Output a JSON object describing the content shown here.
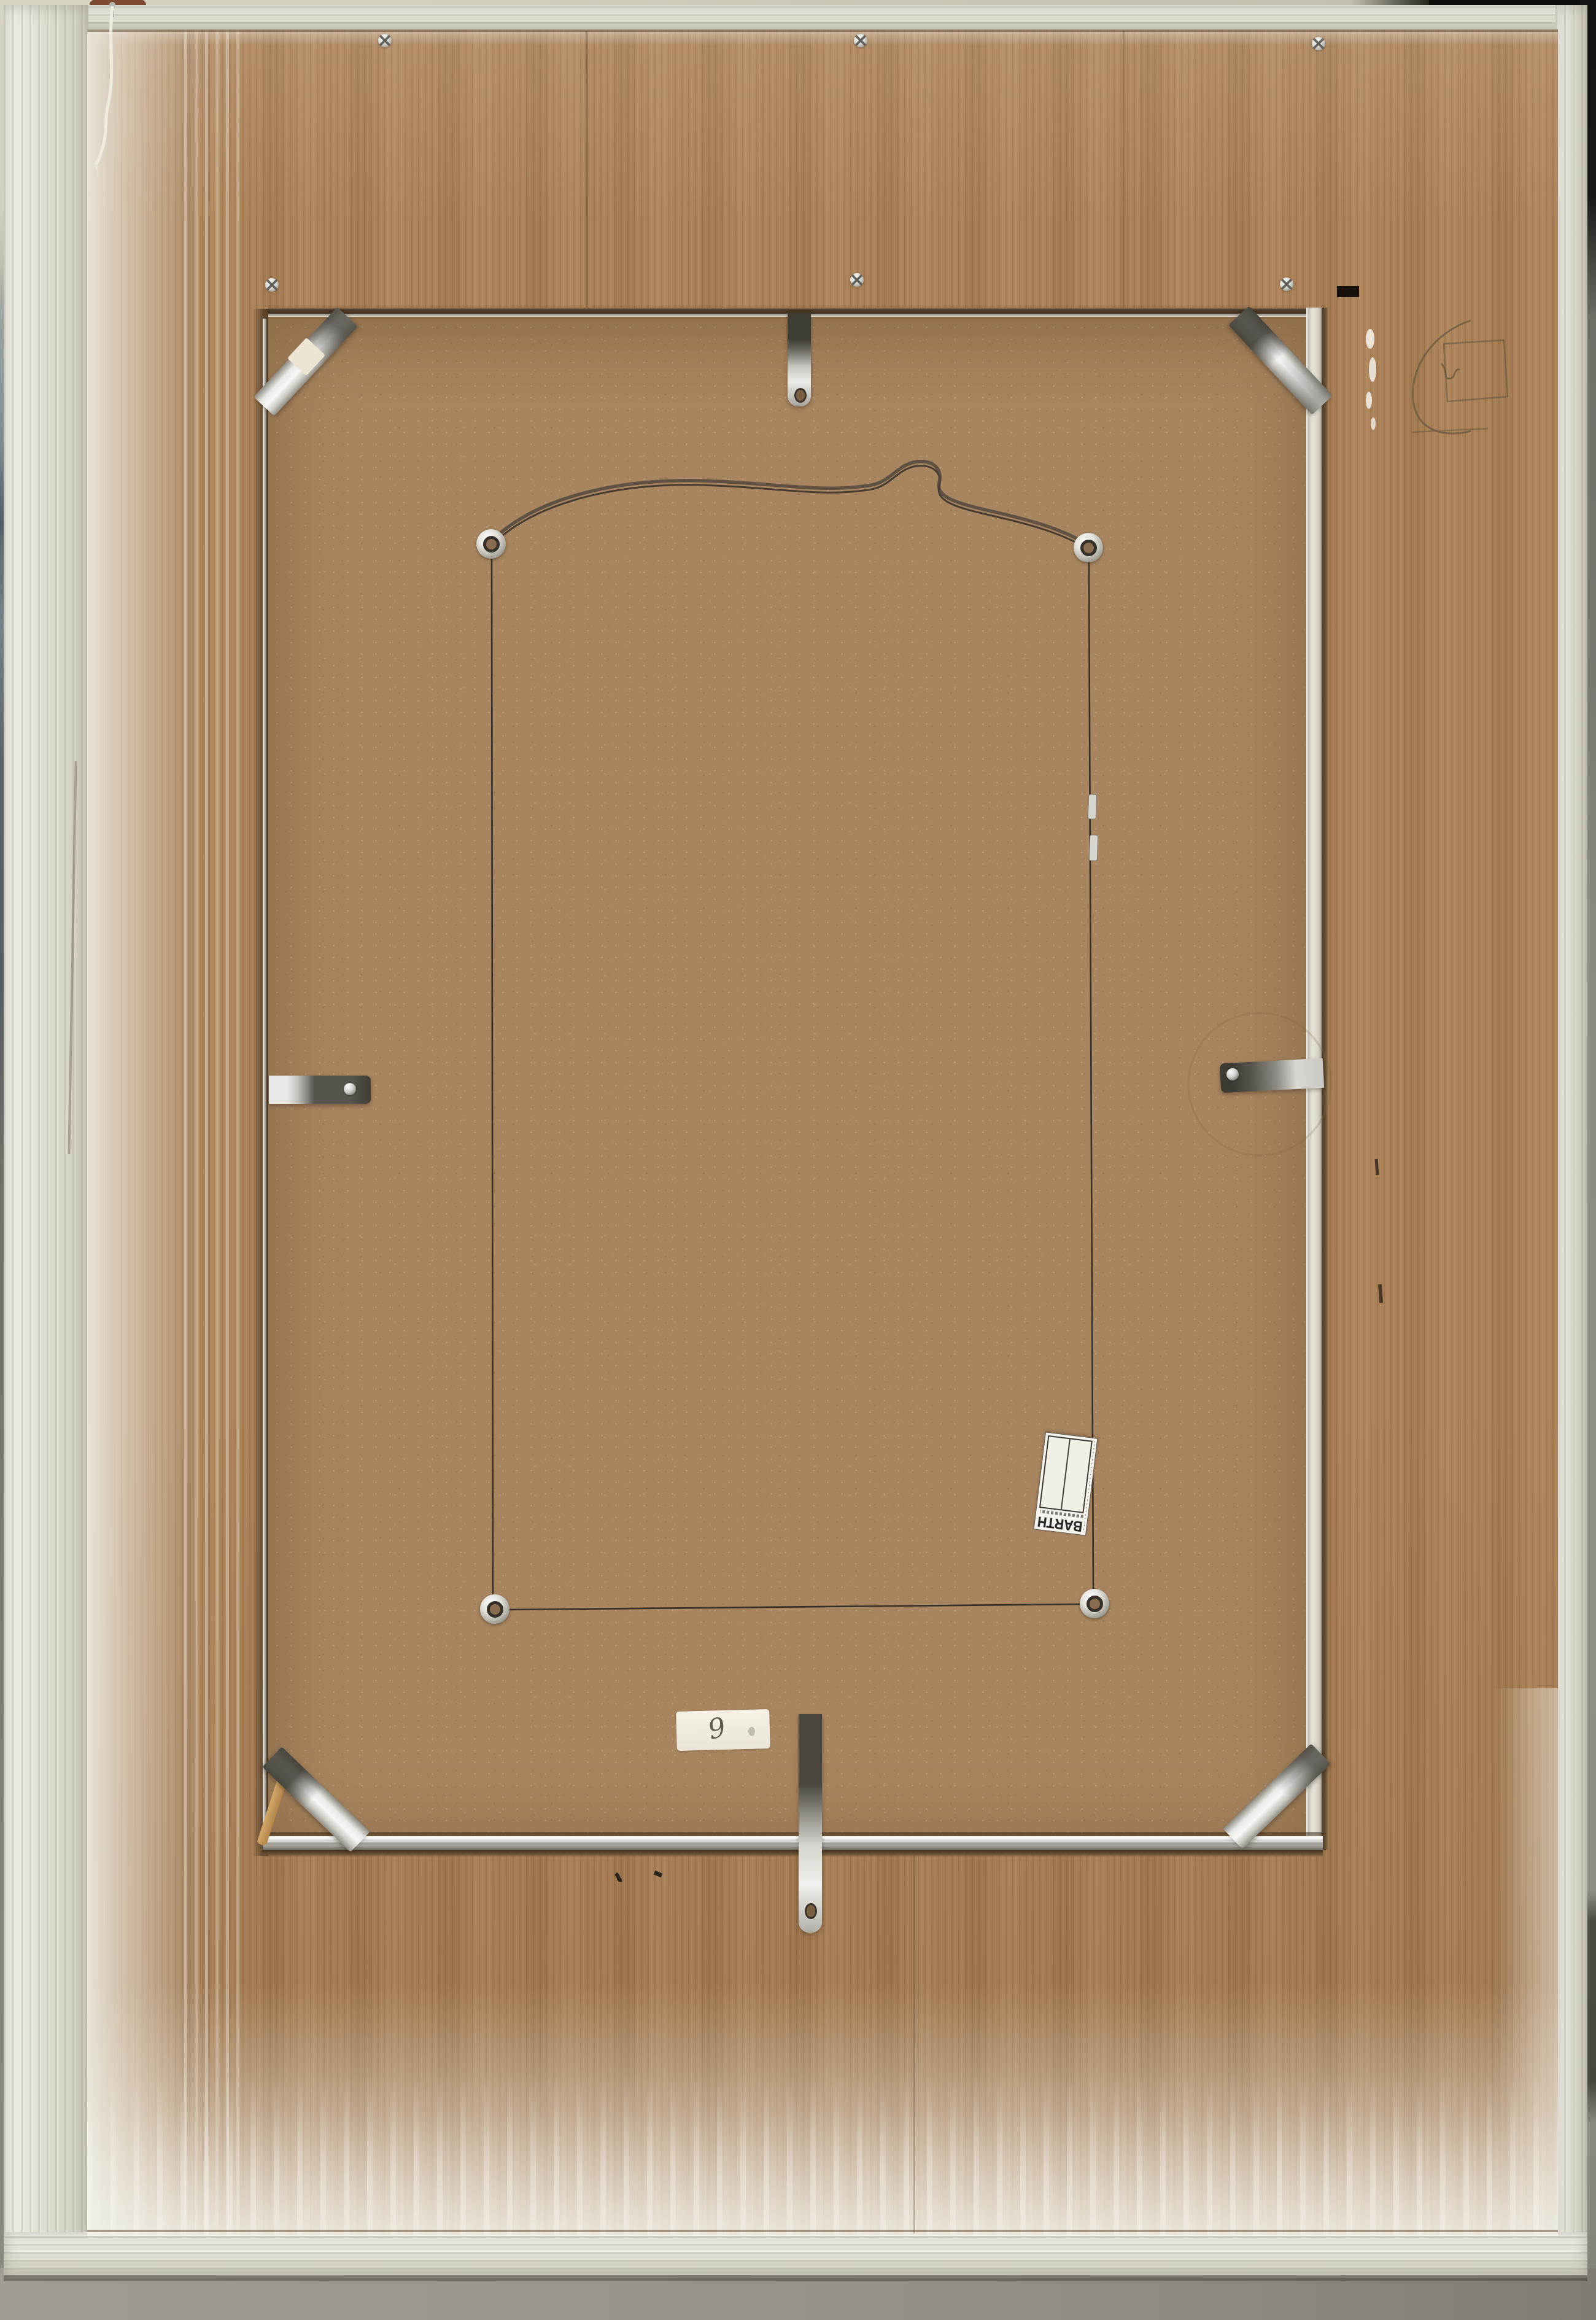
{
  "scene": {
    "subject": "Back of a large white-painted wooden picture frame with plywood back, hardboard insert, metal clips and hanging wire, leaning against a wall",
    "colors": {
      "frame_paint": "#e8e5da",
      "plywood": "#ab8157",
      "backing_board": "#a8845f",
      "metal_hardware": "#d9d8d2",
      "cord": "#35302a",
      "hanging_wire": "#5f5143",
      "wall_left_top": "#d7d3c1",
      "wall_left": "#5b6167",
      "wall_right_top": "#100e0b",
      "wall_right": "#8a887f",
      "floor": "#98948b"
    }
  },
  "labels": {
    "framer_label": {
      "brand": "BARTH",
      "orientation": "upside-down",
      "note": "small print illegible"
    },
    "handwritten_tag": {
      "text": "9"
    }
  },
  "hardware": {
    "corner_braces": 4,
    "edge_clips": 4,
    "eyelet_screws": 4,
    "visible_frame_screws": 6,
    "cord_crimps": 2
  }
}
